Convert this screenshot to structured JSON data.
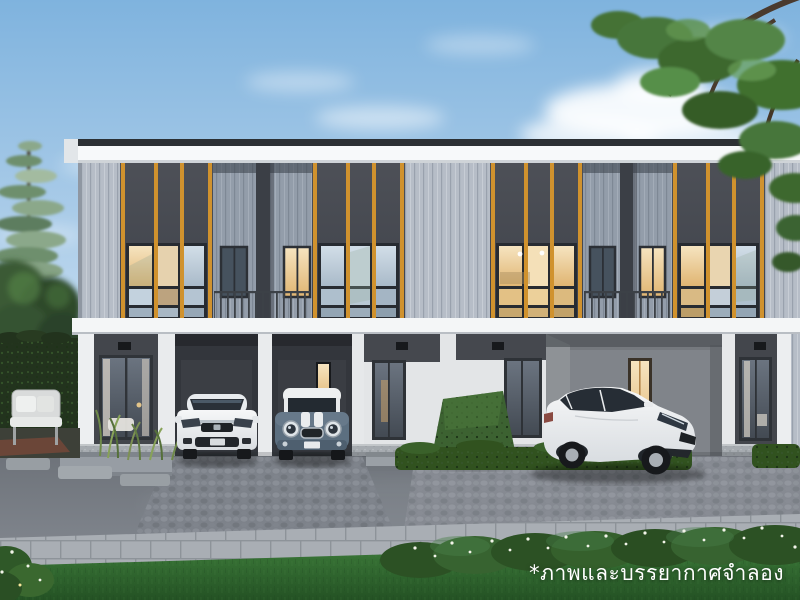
{
  "scene": {
    "type": "architectural-exterior-rendering",
    "subject": "Modern two-storey townhome row at dusk with carports and parked cars",
    "caption": "*ภาพและบรรยากาศจำลอง"
  },
  "palette": {
    "sky_top": "#7fb3de",
    "sky_horizon": "#ecf4fa",
    "fascia_white": "#f7f9fa",
    "siding_light_gray": "#b6bdc7",
    "panel_charcoal": "#46494f",
    "accent_orange": "#d0922e",
    "ground_floor_white": "#e7e9eb",
    "window_warm_light": "#f0d8ad",
    "hedge_green": "#31521f",
    "grass_green": "#2f6530",
    "road_asphalt": "#757a81",
    "caption_color": "#ffffff"
  },
  "objects": {
    "building": "two-storey townhouse row: charcoal feature panels with orange battens and grid windows, grey vertical siding, recessed balconies, white ground-floor columns, carports, glass doors, wall sconces",
    "cars": [
      {
        "name": "white-sedan-front-view",
        "body_color": "#f2f3f4",
        "location": "left carport"
      },
      {
        "name": "mini-hatchback-front-view",
        "body_color": "#5c6f80",
        "roof_color": "#eef0f1",
        "location": "middle carport"
      },
      {
        "name": "white-sedan-angled",
        "body_color": "#f0f2f3",
        "location": "right driveway"
      }
    ],
    "vegetation": [
      "tall-pine-tree-left",
      "deciduous-trees-left",
      "garden-hedge-wall-left",
      "ornamental-grasses-left",
      "overhanging-tree-top-right",
      "topiary-bush-center",
      "low-hedge-rows",
      "flowering-hedge-foreground",
      "front-lawn"
    ],
    "furniture": [
      "outdoor-armchair-left-garden",
      "stepping-stones-left"
    ]
  }
}
